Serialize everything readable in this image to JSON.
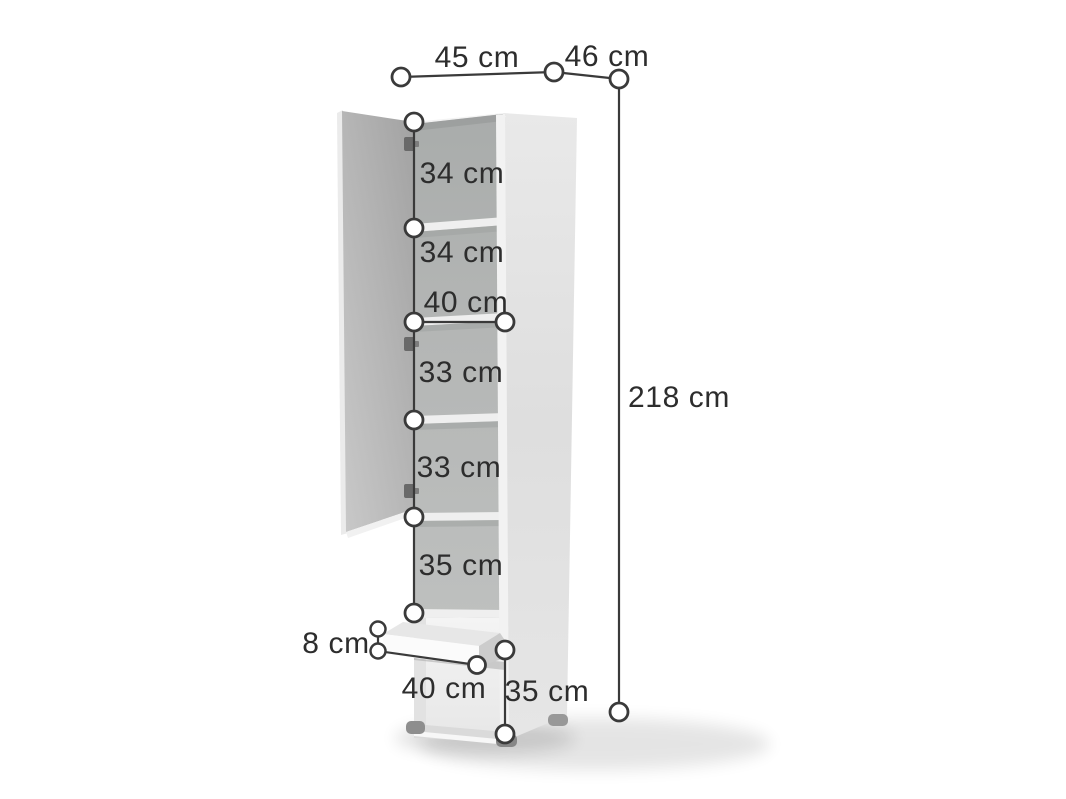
{
  "diagram": {
    "product": "Tall cabinet with open door, five shelf compartments and bottom drawer",
    "unit": "cm",
    "line_color": "#3a3a3a",
    "text_color": "#2d2d2d",
    "labels": {
      "top_width": "45 cm",
      "top_depth": "46 cm",
      "total_height": "218 cm",
      "shelf_1": "34 cm",
      "shelf_2": "34 cm",
      "interior_width": "40 cm",
      "shelf_3": "33 cm",
      "shelf_4": "33 cm",
      "shelf_5": "35 cm",
      "drawer_height": "8 cm",
      "bottom_width": "40 cm",
      "bottom_height": "35 cm"
    },
    "values_cm": {
      "top_width": 45,
      "top_depth": 46,
      "total_height": 218,
      "shelf_sections": [
        34,
        34,
        33,
        33,
        35
      ],
      "interior_width": 40,
      "drawer_front_height": 8,
      "bottom_width": 40,
      "bottom_section_height": 35
    }
  }
}
